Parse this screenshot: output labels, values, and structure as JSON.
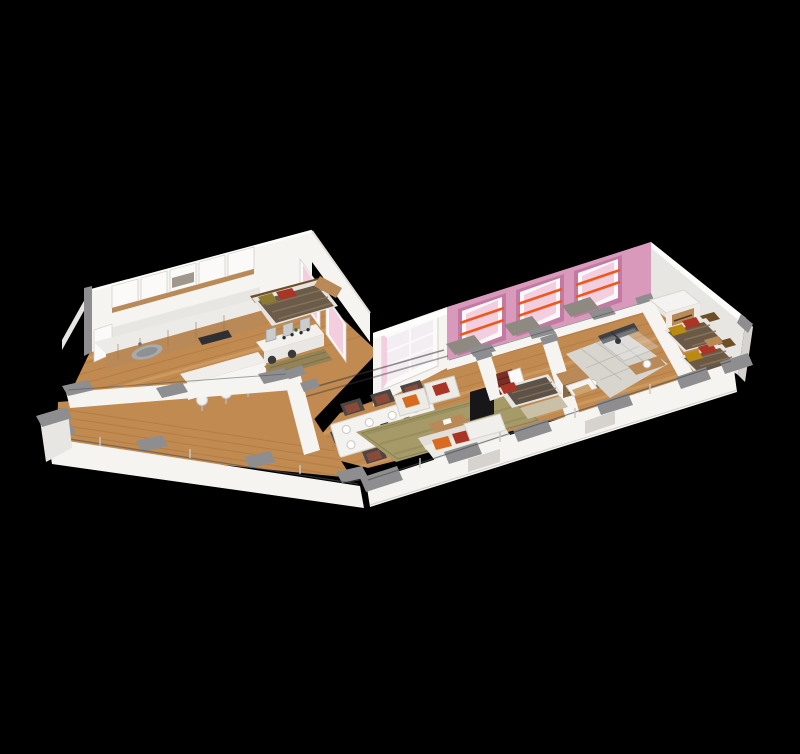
{
  "scene": {
    "type": "isometric-3d-floor-plan-render",
    "view": "cutaway axonometric from above",
    "background": "solid black",
    "floor_material": "oak plank hardwood",
    "facade_accent": "pink wall with three large windows, each with two orange curtain rods",
    "rooms": [
      {
        "name": "kitchen",
        "furniture": [
          "upper-cabinets",
          "counter-with-sink",
          "cooktop",
          "island",
          "bar-stools"
        ]
      },
      {
        "name": "bedroom-left",
        "furniture": [
          "double-bed",
          "vanity-with-mirrors",
          "runner-rug",
          "side-cabinet"
        ]
      },
      {
        "name": "balcony-terrace",
        "furniture": [
          "glass-railing",
          "gray-capped-posts"
        ]
      },
      {
        "name": "dining-area",
        "furniture": [
          "dining-table-set-for-six",
          "upholstered-chairs"
        ]
      },
      {
        "name": "living-room",
        "furniture": [
          "sofa",
          "two-armchairs",
          "coffee-table",
          "tv-on-stand",
          "area-rug"
        ]
      },
      {
        "name": "hallway",
        "furniture": [
          "red-dresser"
        ]
      },
      {
        "name": "small-bedroom",
        "furniture": [
          "single-bed",
          "rug",
          "wardrobe"
        ]
      },
      {
        "name": "bathroom",
        "furniture": [
          "glass-shower",
          "wood-vanity-with-basin",
          "toilet",
          "cabinet"
        ]
      },
      {
        "name": "twin-bedroom",
        "furniture": [
          "two-single-beds",
          "wardrobe",
          "nightstand"
        ]
      }
    ],
    "window_count_pink_facade": 3,
    "curtain_rods_per_window": 2
  },
  "colors": {
    "background": "#000000",
    "wall_lit": "#f5f4f1",
    "wall_mid": "#e8e6e2",
    "wall_shade": "#d6d3ce",
    "cap_gray": "#8e8e90",
    "cap_gray_dark": "#747477",
    "floor_wood": "#c18a50",
    "floor_wood_light": "#d9ac74",
    "floor_wood_dark": "#97682f",
    "pink_wall": "#d999ba",
    "pink_wall_deep": "#c27aa2",
    "pink_glass": "#f3cede",
    "orange_rod": "#f1571d",
    "tile": "#d8d5cf",
    "tile_grout": "#b9b6ae",
    "sofa_white": "#edebe6",
    "cushion_orange": "#d86b1f",
    "cushion_red": "#a93527",
    "cushion_olive": "#8d7b2f",
    "cushion_mustard": "#bb8a12",
    "duvet_dark": "#6b5b49",
    "duvet_stripe": "#8a765e",
    "rug_olive": "#a59a68",
    "rug_beige": "#cabfa7",
    "rug_runner": "#8f8257",
    "chair_dark": "#4b4543",
    "chair_red": "#8a4a3a",
    "table_white": "#f3f2ef",
    "tv_black": "#17171a",
    "glass_line": "#4a4e53",
    "wood_furniture": "#b98a58",
    "wood_dark": "#6e4e26",
    "granite": "#8f8a81",
    "metal": "#9aa0a5",
    "sink_gray": "#a7abad"
  }
}
